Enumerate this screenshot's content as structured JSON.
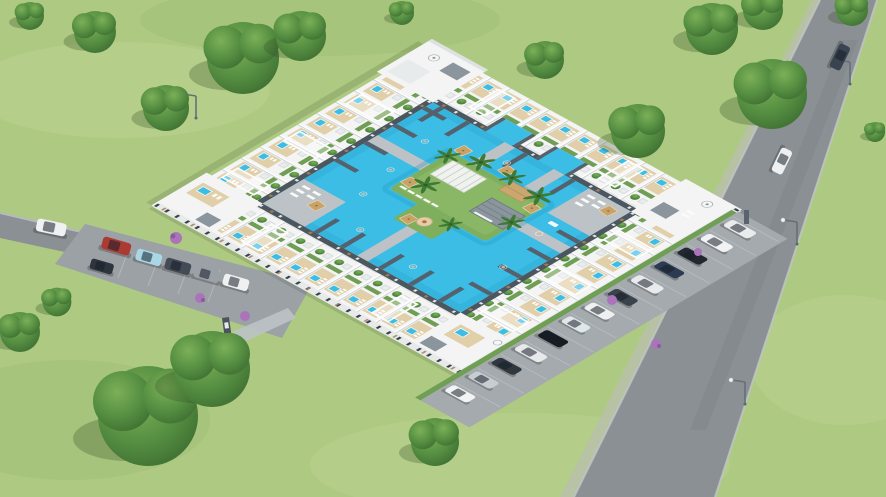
{
  "meta": {
    "alt": "Aerial 3D rendering of a residential complex: white two-storey townhouses with slate grey portal frames arranged in a rectangle around a large turquoise swimming-pool courtyard with a landscaped island holding pergolas, a pool bar, palm trees, tan parasols and sun loungers. Rooftop terraces have small plunge pools, loungers and planted trees. A row of parked cars lines an access lane on the right beside a main road with two driving cars and street lamps; a small car park with cars sits on the left. Green lawns and large trees surround the site."
  },
  "palette": {
    "grass": "#aeca82",
    "grass_light": "#c3d89a",
    "grass_dark": "#93b26c",
    "road": "#8b9094",
    "road_edge": "#c2c6c9",
    "lot": "#9ba1a5",
    "apron": "#a4aaae",
    "walk": "#bcc2c5",
    "pool": "#3bbde6",
    "pool_deep": "#1f95c4",
    "island": "#7fae5c",
    "island_light": "#90bd6b",
    "hedge": "#6f9e54",
    "white": "#f3f4f3",
    "white_shade": "#dde1e2",
    "slate": "#55616c",
    "slate_light": "#8b959d",
    "facade": "#4b565f",
    "wood": "#a9805a",
    "terrace": "#e0cfa8",
    "umbrella": "#c9a268",
    "skin": "#e8b48c",
    "purple": "#ab74ba"
  },
  "scene": {
    "complex": {
      "form": "rectangular ring of townhouses around pool courtyard",
      "rows": 4,
      "roof_features": [
        "terraces",
        "plunge-pools",
        "loungers",
        "pergolas",
        "planted-trees",
        "satellite-dishes"
      ],
      "island_features": [
        "white-pergola",
        "tan-pavilion",
        "pool-bar",
        "parasols",
        "palm-trees",
        "sun-loungers",
        "fire-pit"
      ]
    },
    "counts": {
      "right_row_cars": 13,
      "left_lot_cars": 6,
      "moving_cars": 2,
      "street_lamps": 4,
      "satellite_dishes": 3,
      "palm_trees": 7,
      "parasols": 6,
      "large_trees": 18
    },
    "vehicles": {
      "right_row": [
        "#e9ebec",
        "#f1f2f3",
        "#23282f",
        "#2c3a52",
        "#e8eaeb",
        "#3a424c",
        "#eef0f1",
        "#dfe7ea",
        "#171c22",
        "#e7e9ea",
        "#30383f",
        "#c8cdd1",
        "#f2f3f4"
      ],
      "left_lot": [
        "#ab3a33",
        "#a9d7e6",
        "#434b54",
        "#9aa1a7",
        "#eff0f1",
        "#2e353d"
      ],
      "left_road_suv": "#f0f1f2",
      "main_road": [
        "#3a4450",
        "#edeff0"
      ]
    }
  }
}
